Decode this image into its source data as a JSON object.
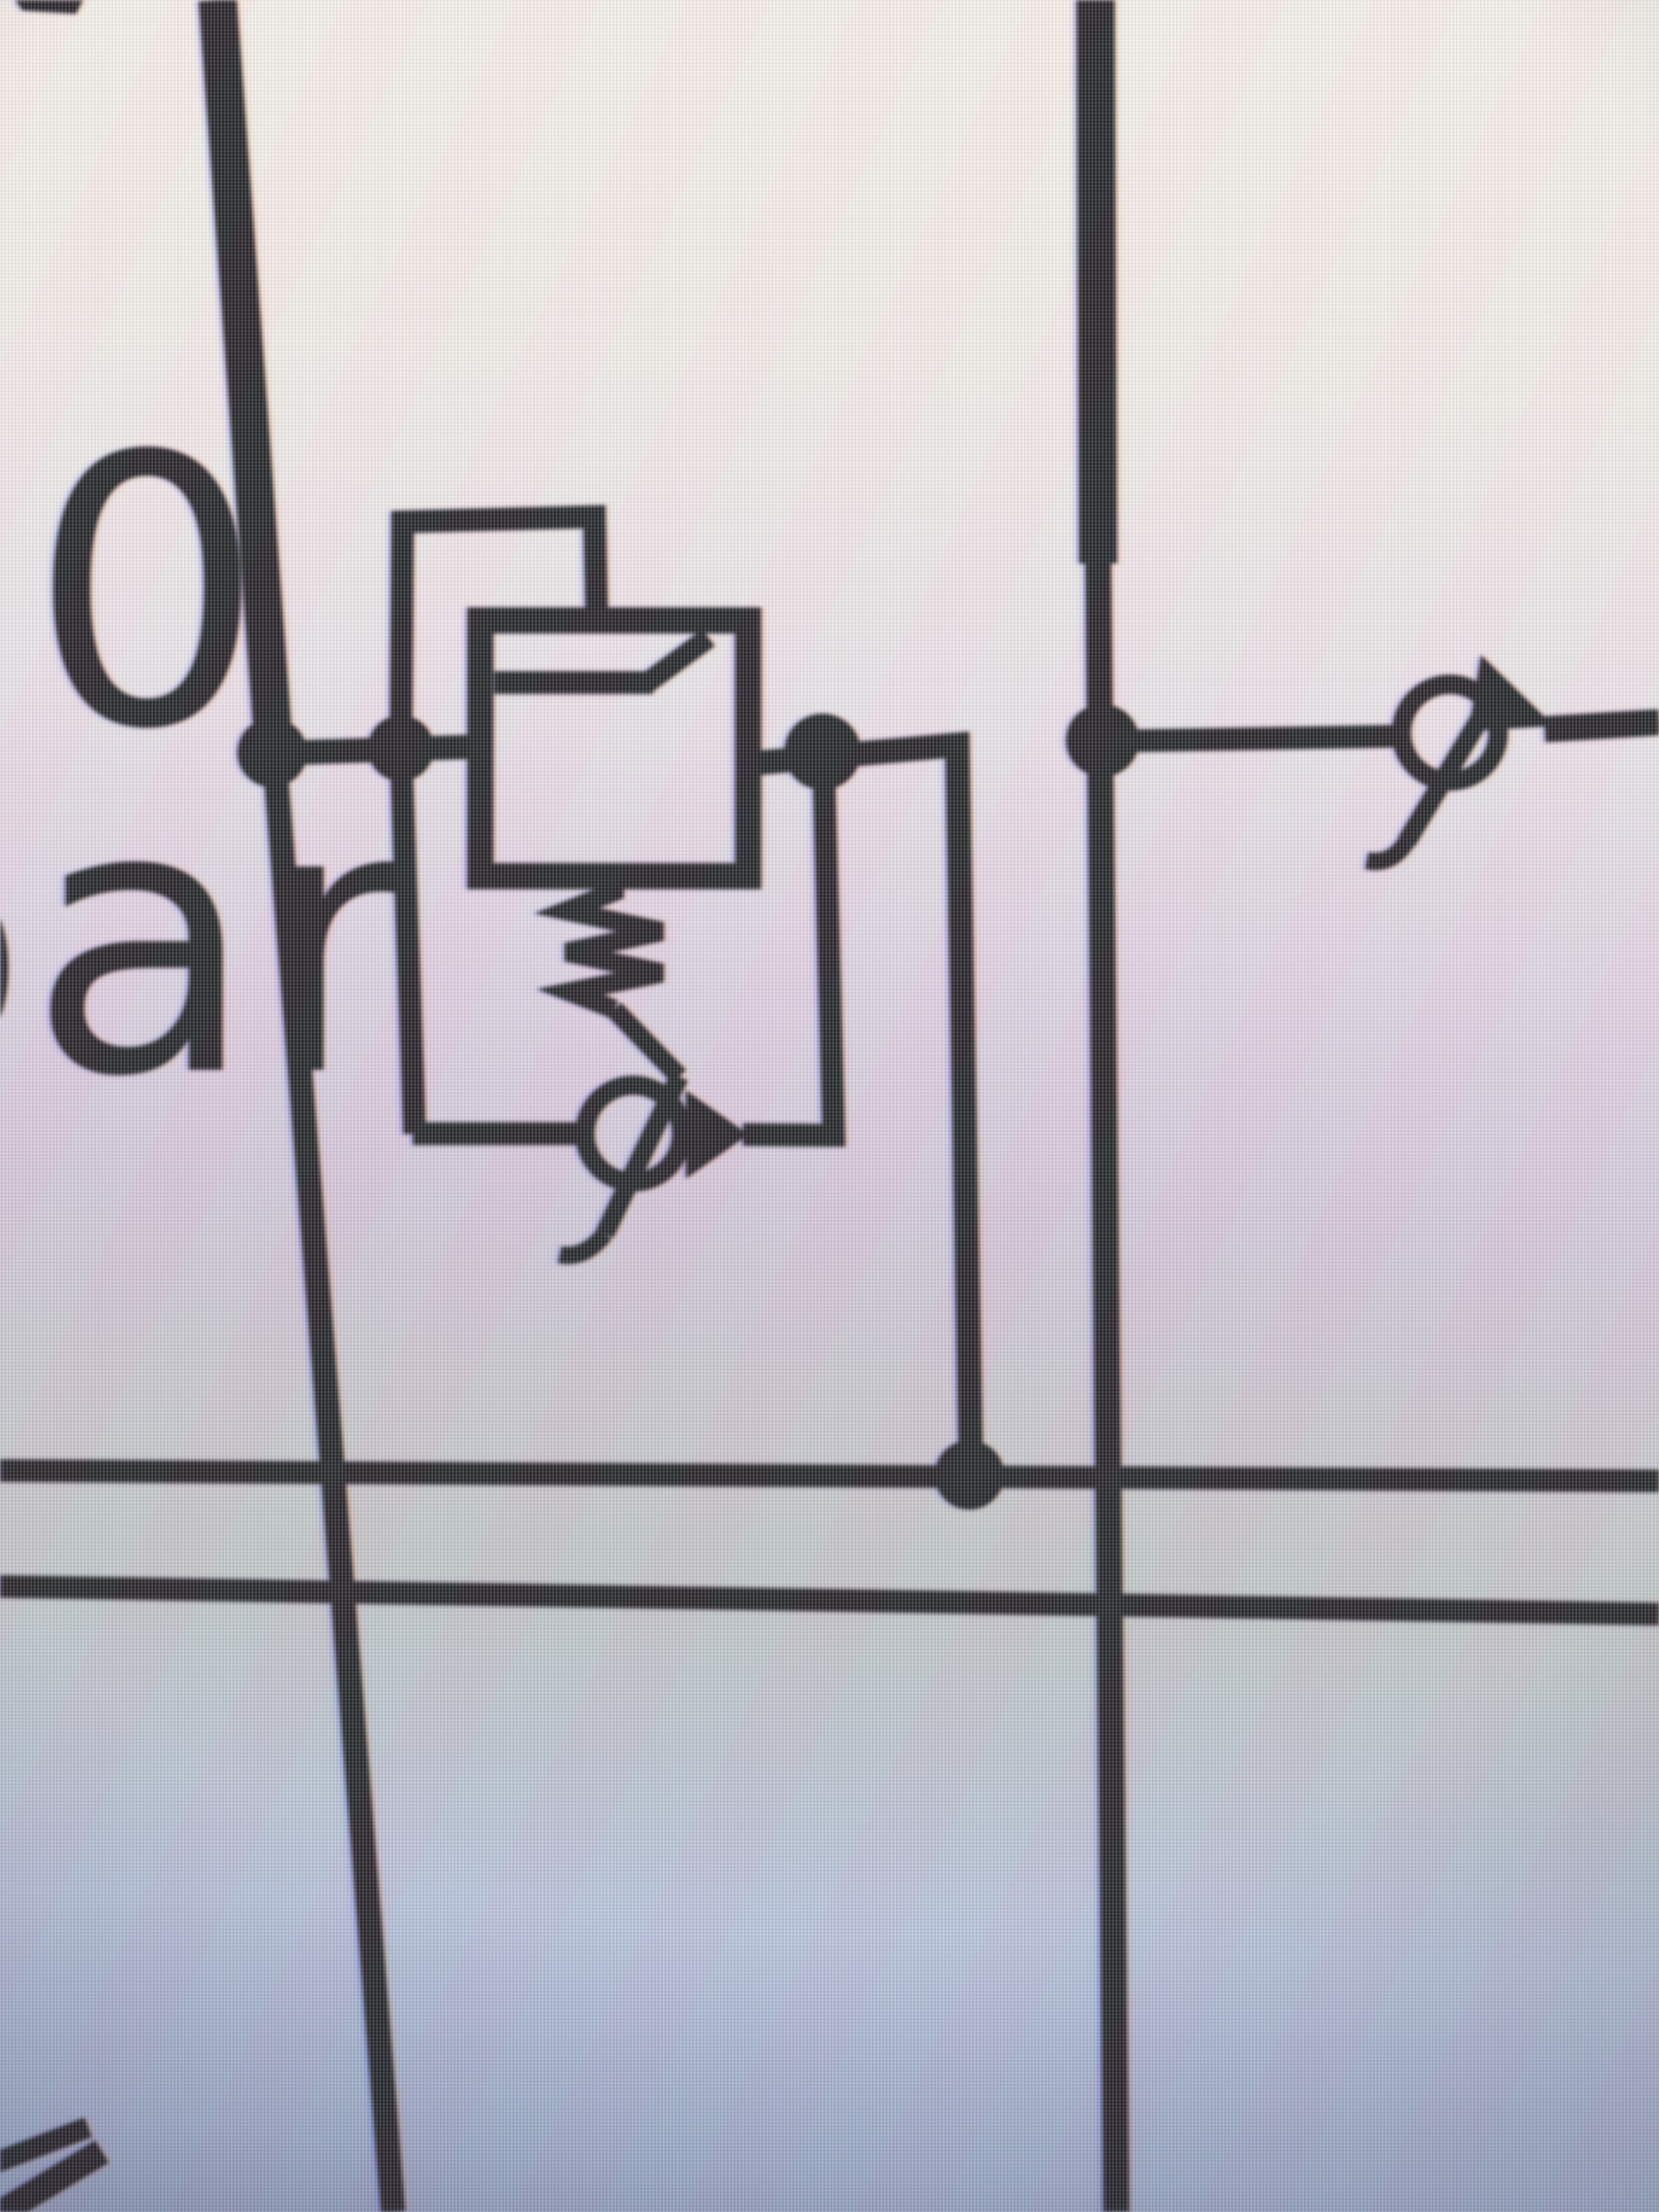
{
  "labels": {
    "pressure_value": "50",
    "pressure_unit": "bar"
  },
  "colors": {
    "ink": "#191919",
    "bg_top": "#f6f0e6",
    "bg_mid_lavender": "#d2c6d5",
    "bg_bottom_blue": "#8f9cba"
  },
  "schematic": {
    "type": "hydraulic-circuit-fragment",
    "components": [
      {
        "name": "vertical-pipe-left",
        "desc": "supply line, thick above junction, thin below, runs top to bottom"
      },
      {
        "name": "vertical-pipe-right",
        "desc": "second supply line, thick above y~650, runs top to bottom"
      },
      {
        "name": "pressure-valve",
        "desc": "square valve body with internal seat passage and corner notch"
      },
      {
        "name": "pilot-line-loop",
        "desc": "rectangular pilot line from upstream junction over to valve top"
      },
      {
        "name": "adjustment-spring",
        "desc": "zig-zag spring under valve body"
      },
      {
        "name": "drain-loop",
        "desc": "line from upstream junction down, across test point, back up to downstream junction"
      },
      {
        "name": "test-point-coupling-bottom",
        "desc": "circle with diagonal arrow and hook on drain loop"
      },
      {
        "name": "test-point-coupling-right",
        "desc": "circle with diagonal arrow and hook on right branch line"
      },
      {
        "name": "junction-dot",
        "count": 5
      },
      {
        "name": "bus-line-upper",
        "desc": "full-width horizontal line"
      },
      {
        "name": "bus-line-lower",
        "desc": "full-width horizontal line"
      },
      {
        "name": "clipped-mark-top-left",
        "desc": "small black fragment at top edge"
      },
      {
        "name": "clipped-glyph-bottom-left",
        "desc": "two diagonal stroke fragments of a clipped character"
      }
    ]
  }
}
